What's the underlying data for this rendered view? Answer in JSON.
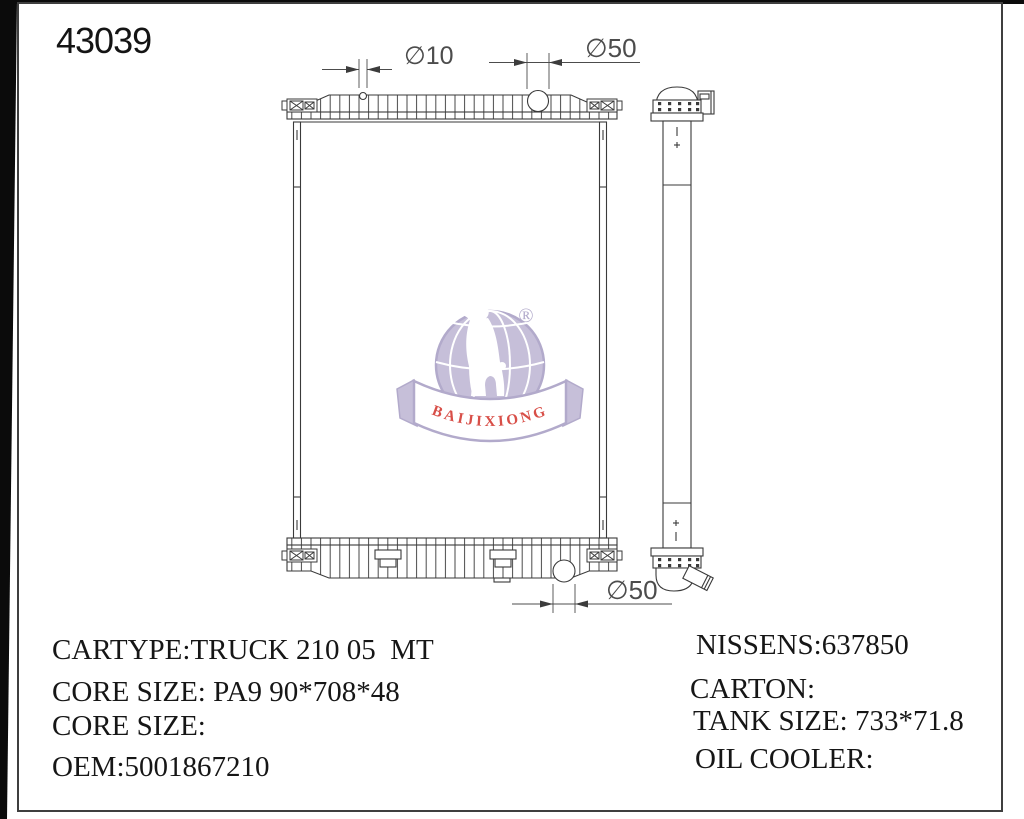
{
  "page": {
    "part_number": "43039"
  },
  "dimensions": {
    "top_small_hole": "∅10",
    "top_filler_neck": "∅50",
    "bottom_outlet": "∅50"
  },
  "logo": {
    "brand": "BAIJIXIONG",
    "registered_mark": "®"
  },
  "specs_left": [
    "CARTYPE:TRUCK 210 05  MT",
    "CORE SIZE: PA9 90*708*48",
    "CORE SIZE:",
    "OEM:5001867210"
  ],
  "specs_right": [
    "NISSENS:637850",
    "CARTON:",
    "TANK SIZE: 733*71.8",
    "OIL COOLER:"
  ]
}
